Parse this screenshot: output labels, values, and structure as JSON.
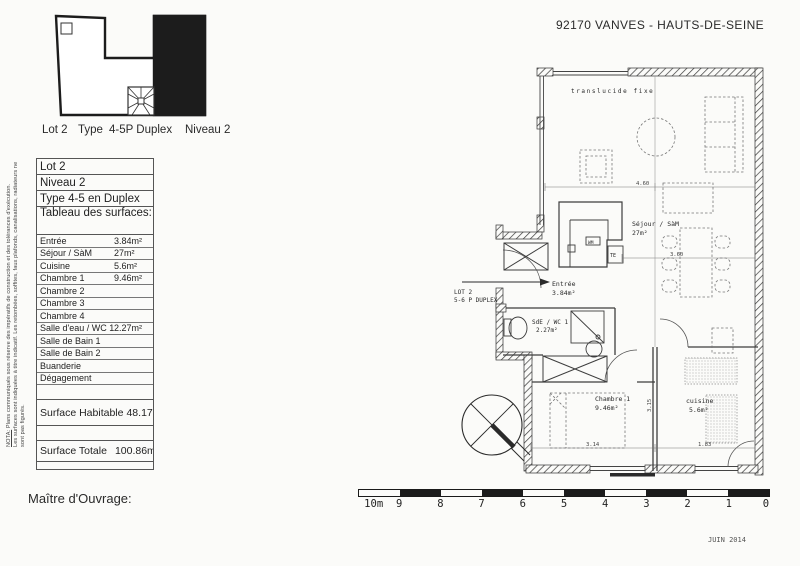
{
  "header": {
    "location": "92170 VANVES  -  HAUTS-DE-SEINE"
  },
  "key_plan": {
    "caption": {
      "lot": "Lot 2",
      "type_label": "Type",
      "type_value": "4-5P Duplex",
      "niveau": "Niveau 2"
    }
  },
  "surface_table": {
    "lot": "Lot 2",
    "niveau": "Niveau 2",
    "type": "Type 4-5 en Duplex",
    "tableau": "Tableau des surfaces:",
    "rows": [
      {
        "label": "Entrée",
        "value": "3.84m²"
      },
      {
        "label": "Séjour / SàM",
        "value": "27m²"
      },
      {
        "label": "Cuisine",
        "value": "5.6m²"
      },
      {
        "label": "Chambre 1",
        "value": "9.46m²"
      },
      {
        "label": "Chambre 2",
        "value": ""
      },
      {
        "label": "Chambre 3",
        "value": ""
      },
      {
        "label": "Chambre 4",
        "value": ""
      },
      {
        "label": "Salle d'eau / WC 1",
        "value": "2.27m²"
      },
      {
        "label": "Salle de Bain 1",
        "value": ""
      },
      {
        "label": "Salle de Bain 2",
        "value": ""
      },
      {
        "label": "Buanderie",
        "value": ""
      },
      {
        "label": "Dégagement",
        "value": ""
      }
    ],
    "totals": {
      "habitable_label": "Surface Habitable",
      "habitable_value": "48.17m²",
      "totale_label": "Surface Totale",
      "totale_value": "100.86m²"
    }
  },
  "disclaimer": {
    "nota": "NOTA:",
    "line1": " Plans communiqués sous réserve des impératifs de construction et des tolérances d'exécution.",
    "line2": "Les surfaces sont indiquées à titre indicatif. Les retombées, soffites, faux plafonds, canalisations, radiateurs ne sont pas figurés."
  },
  "plan": {
    "window_label": "translucide fixe",
    "rooms": {
      "sejour": {
        "name": "Séjour / SàM",
        "area": "27m²"
      },
      "entree": {
        "name": "Entrée",
        "area": "3.84m²"
      },
      "sde": {
        "name": "SdE / WC 1",
        "area": "2.27m²"
      },
      "chambre1": {
        "name": "Chambre 1",
        "area": "9.46m²"
      },
      "cuisine": {
        "name": "cuisine",
        "area": "5.6m²"
      }
    },
    "callout": {
      "line1": "LOT 2",
      "line2": "5-6 P DUPLEX"
    },
    "equipment": {
      "te": "TE",
      "wm": "WM"
    },
    "dims": {
      "sejour_width": "4.60",
      "dining_width": "3.60",
      "chambre_width": "3.14",
      "cuisine_width": "1.83",
      "room_depth": "3.15"
    }
  },
  "scale_bar": {
    "labels": [
      "10m",
      "9",
      "8",
      "7",
      "6",
      "5",
      "4",
      "3",
      "2",
      "1",
      "0"
    ]
  },
  "footer": {
    "maitre": "Maître d'Ouvrage:",
    "date": "JUIN 2014"
  },
  "colors": {
    "ink": "#222222",
    "wall_fill_dark": "#1c1c1c"
  }
}
